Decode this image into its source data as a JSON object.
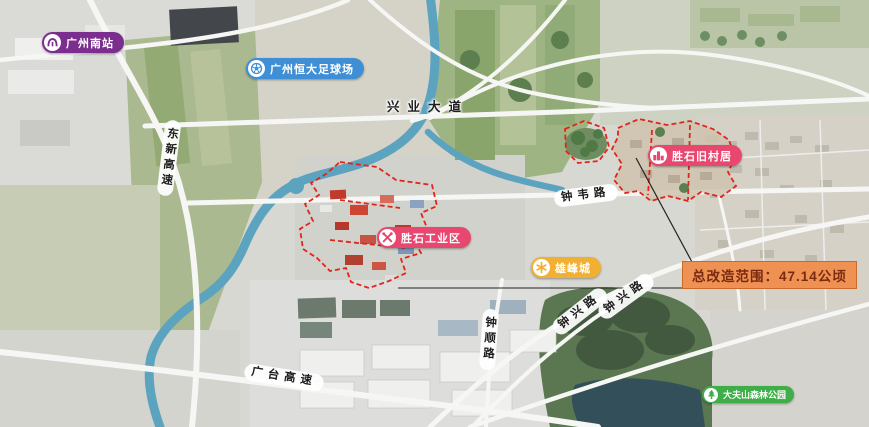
{
  "map": {
    "markers": {
      "station": {
        "label": "广州南站",
        "icon": "metro-icon",
        "color": "#7b2e8d"
      },
      "stadium": {
        "label": "广州恒大足球场",
        "icon": "soccer-icon",
        "color": "#3f8fd6"
      },
      "old_village": {
        "label": "胜石旧村居",
        "icon": "village-icon",
        "color": "#e8476f"
      },
      "industrial": {
        "label": "胜石工业区",
        "icon": "tools-icon",
        "color": "#e8476f"
      },
      "xiongfeng": {
        "label": "雄峰城",
        "icon": "flower-icon",
        "color": "#f2b033"
      },
      "forest_park": {
        "label": "大夫山森林公园",
        "icon": "tree-icon",
        "color": "#3fae49"
      }
    },
    "roads": {
      "xingye": {
        "label": "兴业大道"
      },
      "dongxin": {
        "label": "东新高速"
      },
      "zhongwei": {
        "label": "钟韦路"
      },
      "zhongxing_a": {
        "label": "钟兴路"
      },
      "zhongxing_b": {
        "label": "钟兴路"
      },
      "zhongshun": {
        "label": "钟顺路"
      },
      "guangtai": {
        "label": "广台高速"
      }
    },
    "callout": {
      "label": "总改造范围：47.14公顷",
      "bg": "#ef9152",
      "fg": "#7a2a10"
    },
    "colors": {
      "redevelopment_boundary": "#e1251b",
      "river": "#5ba3bf",
      "road": "#f6f7f4"
    }
  }
}
